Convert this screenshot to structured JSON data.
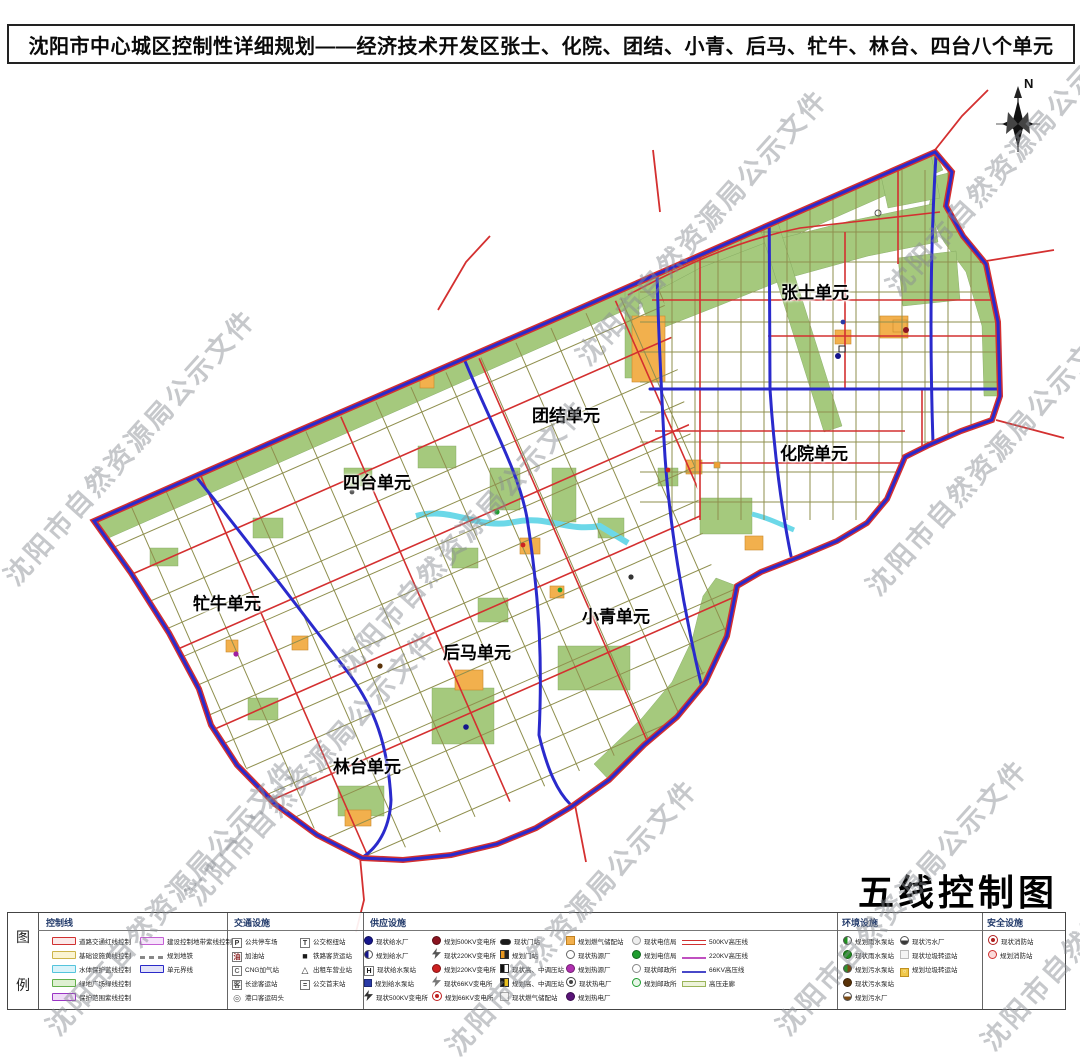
{
  "title": "沈阳市中心城区控制性详细规划——经济技术开发区张士、化院、团结、小青、后马、牤牛、林台、四台八个单元",
  "map": {
    "compass_label": "N",
    "big_title": "五线控制图",
    "watermark": "沈阳市自然资源局公示文件",
    "watermarks": [
      {
        "x": 8,
        "y": 560
      },
      {
        "x": 340,
        "y": 650
      },
      {
        "x": 580,
        "y": 340
      },
      {
        "x": 870,
        "y": 570
      },
      {
        "x": 890,
        "y": 270
      },
      {
        "x": 50,
        "y": 1010
      },
      {
        "x": 450,
        "y": 1030
      },
      {
        "x": 780,
        "y": 1010
      },
      {
        "x": 190,
        "y": 880
      },
      {
        "x": 985,
        "y": 1025
      }
    ],
    "units": [
      {
        "label": "张士单元",
        "x": 815,
        "y": 291
      },
      {
        "label": "化院单元",
        "x": 814,
        "y": 452
      },
      {
        "label": "团结单元",
        "x": 566,
        "y": 414
      },
      {
        "label": "四台单元",
        "x": 377,
        "y": 481
      },
      {
        "label": "牤牛单元",
        "x": 227,
        "y": 602
      },
      {
        "label": "小青单元",
        "x": 616,
        "y": 615
      },
      {
        "label": "后马单元",
        "x": 477,
        "y": 651
      },
      {
        "label": "林台单元",
        "x": 367,
        "y": 765
      }
    ]
  },
  "legend": {
    "caption_top": "图",
    "caption_bottom": "例",
    "headers": [
      "控制线",
      "交通设施",
      "供应设施",
      "环境设施",
      "安全设施"
    ],
    "control_a": [
      {
        "label": "道路交通红线控制",
        "icon": {
          "t": "chip",
          "c": "#d03030",
          "c2": "#fbe9e9"
        }
      },
      {
        "label": "基础设施黄线控制",
        "icon": {
          "t": "chip",
          "c": "#cdb44a",
          "c2": "#fbf4d2"
        }
      },
      {
        "label": "水体保护蓝线控制",
        "icon": {
          "t": "chip",
          "c": "#54c4dc",
          "c2": "#d9f3fa"
        }
      },
      {
        "label": "绿地广场绿线控制",
        "icon": {
          "t": "chip",
          "c": "#63b04a",
          "c2": "#def0d2"
        }
      },
      {
        "label": "保护范围紫线控制",
        "icon": {
          "t": "chip",
          "c": "#9a35c5",
          "c2": "#efdbf7"
        }
      }
    ],
    "control_b": [
      {
        "label": "建设控制地带紫线控制",
        "icon": {
          "t": "chip",
          "c": "#c45fd4",
          "c2": "#f6e3fb"
        }
      },
      {
        "label": "规划地铁",
        "icon": {
          "t": "dash",
          "c": "#888888"
        }
      },
      {
        "label": "单元界线",
        "icon": {
          "t": "chip",
          "c": "#2a2ac8",
          "c2": "#e2e2f8"
        }
      }
    ],
    "traffic_a": [
      {
        "label": "公共停车场",
        "icon": {
          "t": "sqc",
          "ch": "P",
          "c": "#333333"
        }
      },
      {
        "label": "加油站",
        "icon": {
          "t": "sqc",
          "ch": "油",
          "c": "#8a2020"
        }
      },
      {
        "label": "CNG加气站",
        "icon": {
          "t": "sqc",
          "ch": "C",
          "c": "#666666"
        }
      },
      {
        "label": "长途客运站",
        "icon": {
          "t": "sqc",
          "ch": "客",
          "c": "#555555"
        }
      },
      {
        "label": "港口客运码头",
        "icon": {
          "t": "chr",
          "ch": "◎",
          "c": "#555555"
        }
      }
    ],
    "traffic_b": [
      {
        "label": "公交枢纽站",
        "icon": {
          "t": "sqc",
          "ch": "T",
          "c": "#333333"
        }
      },
      {
        "label": "铁路客货运站",
        "icon": {
          "t": "chr",
          "ch": "■",
          "c": "#1a1a1a"
        }
      },
      {
        "label": "出租车营业站",
        "icon": {
          "t": "chr",
          "ch": "△",
          "c": "#333333"
        }
      },
      {
        "label": "公交首末站",
        "icon": {
          "t": "sqc",
          "ch": "=",
          "c": "#333333"
        }
      }
    ],
    "supply_a": [
      {
        "label": "现状给水厂",
        "icon": {
          "t": "cir",
          "c": "#16168c"
        }
      },
      {
        "label": "规划给水厂",
        "icon": {
          "t": "cirh",
          "c": "#16168c"
        }
      },
      {
        "label": "现状给水泵站",
        "icon": {
          "t": "sqc",
          "ch": "H",
          "c": "#111111"
        }
      },
      {
        "label": "规划给水泵站",
        "icon": {
          "t": "sq",
          "c": "#2a3aa6"
        }
      },
      {
        "label": "现状500KV变电所",
        "icon": {
          "t": "bolt",
          "c": "#333333"
        }
      }
    ],
    "supply_b": [
      {
        "label": "规划500KV变电所",
        "icon": {
          "t": "cir",
          "c": "#8b1420"
        }
      },
      {
        "label": "现状220KV变电所",
        "icon": {
          "t": "bolt",
          "c": "#555555"
        }
      },
      {
        "label": "规划220KV变电所",
        "icon": {
          "t": "cir",
          "c": "#cc2020"
        }
      },
      {
        "label": "现状66KV变电所",
        "icon": {
          "t": "bolt",
          "c": "#777777"
        }
      },
      {
        "label": "规划66KV变电所",
        "icon": {
          "t": "target",
          "c": "#c02020"
        }
      }
    ],
    "supply_c": [
      {
        "label": "现状门站",
        "icon": {
          "t": "rrect",
          "c": "#1a1a1a"
        }
      },
      {
        "label": "规划门站",
        "icon": {
          "t": "vsplit",
          "c": "#e89820",
          "c2": "#222222"
        }
      },
      {
        "label": "现状高、中调压站",
        "icon": {
          "t": "vsplit",
          "c": "#111111",
          "c2": "#ffffff"
        }
      },
      {
        "label": "规划高、中调压站",
        "icon": {
          "t": "vsplit",
          "c": "#111111",
          "c2": "#e8c020"
        }
      },
      {
        "label": "现状燃气储配站",
        "icon": {
          "t": "sqo",
          "c": "#aaaaaa",
          "c2": "#f3f3f3"
        }
      }
    ],
    "supply_d": [
      {
        "label": "规划燃气储配站",
        "icon": {
          "t": "sqo",
          "c": "#c08020",
          "c2": "#f2b04d"
        }
      },
      {
        "label": "现状热源厂",
        "icon": {
          "t": "ring",
          "c": "#666666"
        }
      },
      {
        "label": "规划热源厂",
        "icon": {
          "t": "cir",
          "c": "#b030b0"
        }
      },
      {
        "label": "现状热电厂",
        "icon": {
          "t": "target",
          "c": "#444444"
        }
      },
      {
        "label": "规划热电厂",
        "icon": {
          "t": "cir",
          "c": "#5a1478"
        }
      }
    ],
    "supply_e": [
      {
        "label": "现状电信局",
        "icon": {
          "t": "ring",
          "c": "#999999",
          "c2": "#eeeeee"
        }
      },
      {
        "label": "规划电信局",
        "icon": {
          "t": "cir",
          "c": "#1f9d2f"
        }
      },
      {
        "label": "现状邮政所",
        "icon": {
          "t": "ring",
          "c": "#888888"
        }
      },
      {
        "label": "规划邮政所",
        "icon": {
          "t": "ring",
          "c": "#1f9d2f",
          "c2": "#e8f6e8"
        }
      }
    ],
    "supply_f": [
      {
        "label": "500KV高压线",
        "icon": {
          "t": "dline",
          "c": "#d03030"
        }
      },
      {
        "label": "220KV高压线",
        "icon": {
          "t": "line",
          "c": "#c050c0"
        }
      },
      {
        "label": "66KV高压线",
        "icon": {
          "t": "line",
          "c": "#4848c8"
        }
      },
      {
        "label": "高压走廊",
        "icon": {
          "t": "band",
          "c": "#9ab45a",
          "c2": "#edf3da"
        }
      }
    ],
    "env_a": [
      {
        "label": "规划雨水泵站",
        "icon": {
          "t": "cirh",
          "c": "#1f8f1f"
        }
      },
      {
        "label": "现状雨水泵站",
        "icon": {
          "t": "cir",
          "c": "#1f8f1f"
        }
      },
      {
        "label": "规划污水泵站",
        "icon": {
          "t": "cirh",
          "c": "#2d8f2d",
          "c2": "#7a4a14"
        }
      },
      {
        "label": "现状污水泵站",
        "icon": {
          "t": "cir",
          "c": "#5a3208"
        }
      },
      {
        "label": "规划污水厂",
        "icon": {
          "t": "cirb",
          "c": "#7a4a14"
        }
      }
    ],
    "env_b": [
      {
        "label": "现状污水厂",
        "icon": {
          "t": "cirb",
          "c": "#3a3a3a"
        }
      },
      {
        "label": "现状垃圾转运站",
        "icon": {
          "t": "sqo",
          "c": "#bbbbbb",
          "c2": "#f4f4f4"
        }
      },
      {
        "label": "规划垃圾转运站",
        "icon": {
          "t": "sqo",
          "ch": "○",
          "c": "#c09020",
          "c2": "#f0c84a"
        }
      }
    ],
    "safety": [
      {
        "label": "现状消防站",
        "icon": {
          "t": "target",
          "c": "#b02020"
        }
      },
      {
        "label": "规划消防站",
        "icon": {
          "t": "ring",
          "c": "#d03030",
          "c2": "#fbdada"
        }
      }
    ]
  }
}
